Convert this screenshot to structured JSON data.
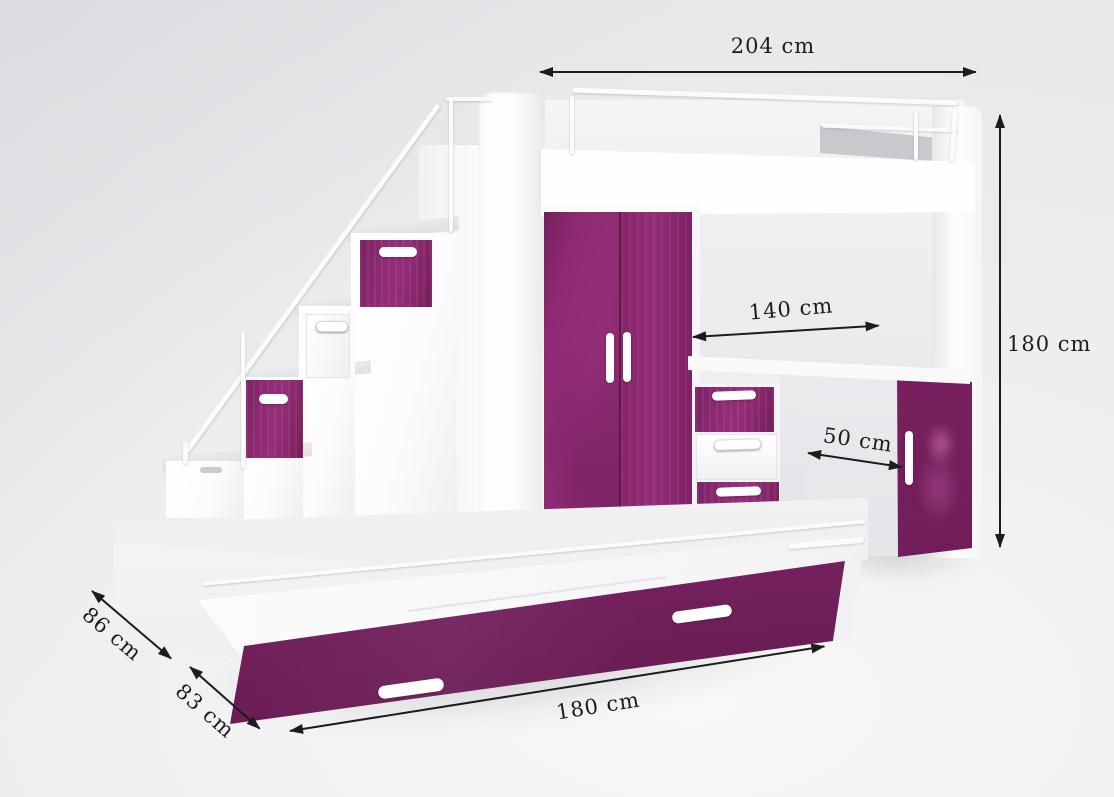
{
  "scene": {
    "description": "Furniture product render: white and glossy-purple loft bed set with storage stairs, wardrobe, desk, drawer chest, cabinet and pull-out trundle bed, annotated with dimension arrows",
    "colors": {
      "accent_purple": "#8E2A73",
      "accent_purple_dark": "#6C1D55",
      "furniture_white": "#FFFFFF",
      "background_gray": "#ECECEE",
      "annotation_ink": "#1C1C1C"
    },
    "icons": {
      "dimension_arrow": "double-headed-arrow"
    }
  },
  "dimensions": {
    "overall_width": {
      "label": "204 cm"
    },
    "overall_height": {
      "label": "180 cm"
    },
    "desk_length": {
      "label": "140 cm"
    },
    "desk_depth": {
      "label": "50 cm"
    },
    "bed_depth": {
      "label": "86 cm"
    },
    "trundle_depth": {
      "label": "83 cm"
    },
    "trundle_length": {
      "label": "180 cm"
    }
  }
}
